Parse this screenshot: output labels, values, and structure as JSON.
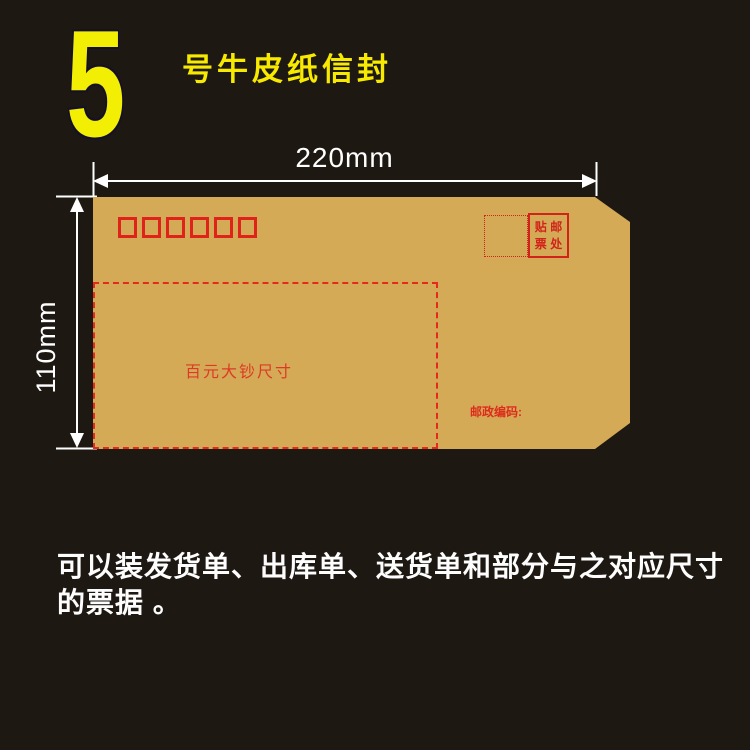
{
  "page": {
    "background_color": "#1e1813",
    "accent_yellow": "#f2ee04",
    "envelope_color": "#d5aa57",
    "red_print_color": "#d2231b"
  },
  "header": {
    "big_number": "5",
    "title": "号牛皮纸信封"
  },
  "dimensions": {
    "width_label": "220mm",
    "height_label": "110mm"
  },
  "envelope": {
    "postal_code_box_count": 6,
    "stamp_area": {
      "chars": [
        "贴",
        "邮",
        "票",
        "处"
      ]
    },
    "cash_note_label": "百元大钞尺寸",
    "postcode_label": "邮政编码:"
  },
  "description": {
    "line1": "可以装发货单、出库单、送货单和部分与之对应尺寸",
    "line2": "的票据 。"
  }
}
